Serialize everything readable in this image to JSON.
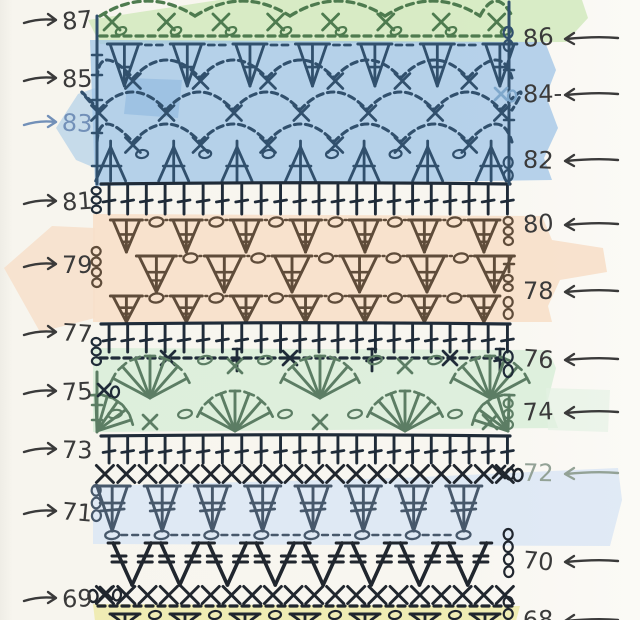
{
  "page": {
    "title": "Hand-drawn crochet stitch chart, rows 68-87, with highlighter color bands"
  },
  "inks": {
    "green": "#4e7b4f",
    "blueInk": "#31506d",
    "navy": "#1f2b38",
    "brown": "#5f4c3a",
    "slate": "#47586b",
    "black": "#20262e",
    "fan": "#5c7d64",
    "pencil": "#3a3a3a",
    "bluePencil": "#7290b8",
    "greenPencil": "#93a296",
    "lightBlue": "#7fa8cc"
  },
  "bands": [
    {
      "name": "band-green-top",
      "fill": "#cfe8ba",
      "opacity": 0.8,
      "points": "258,-6 580,-6 588,18 566,42 100,44 88,20"
    },
    {
      "name": "band-blue-upper",
      "fill": "#9fc4e7",
      "opacity": 0.75,
      "points": "90,40 545,42 556,70 546,96 558,128 544,158 552,180 95,186"
    },
    {
      "name": "band-blue-spike",
      "fill": "#9fc4e7",
      "opacity": 0.55,
      "points": "95,88 95,168 76,160 56,128 78,94"
    },
    {
      "name": "band-blue-patch",
      "fill": "#79abdb",
      "opacity": 0.38,
      "points": "128,78 182,80 178,118 124,114"
    },
    {
      "name": "band-orange-main",
      "fill": "#f7dfca",
      "opacity": 0.92,
      "points": "93,214 542,216 552,240 603,248 607,272 560,280 548,306 552,322 93,322"
    },
    {
      "name": "band-orange-left",
      "fill": "#f7dfca",
      "opacity": 0.85,
      "points": "95,228 95,318 40,332 4,268 52,226"
    },
    {
      "name": "band-green-mid",
      "fill": "#d9eeda",
      "opacity": 0.88,
      "points": "93,348 548,350 556,368 548,400 558,428 93,432"
    },
    {
      "name": "band-green-mid-right",
      "fill": "#e4f1e4",
      "opacity": 0.65,
      "points": "546,388 610,390 608,432 548,430"
    },
    {
      "name": "band-blue-lower",
      "fill": "#dbe6f4",
      "opacity": 0.85,
      "points": "93,486 400,478 618,468 622,500 610,546 93,544"
    },
    {
      "name": "band-yellow",
      "fill": "#eeebad",
      "opacity": 0.9,
      "points": "93,604 520,606 516,621 95,621"
    }
  ],
  "left_labels": [
    {
      "row": "87",
      "y": 20
    },
    {
      "row": "85",
      "y": 78
    },
    {
      "row": "83",
      "y": 122,
      "color": "#7290b8"
    },
    {
      "row": "81",
      "y": 201
    },
    {
      "row": "79",
      "y": 264
    },
    {
      "row": "77",
      "y": 332
    },
    {
      "row": "75",
      "y": 391
    },
    {
      "row": "73",
      "y": 449
    },
    {
      "row": "71",
      "y": 511
    },
    {
      "row": "69",
      "y": 598
    }
  ],
  "right_labels": [
    {
      "row": "86",
      "y": 38
    },
    {
      "row": "84-",
      "y": 94
    },
    {
      "row": "82",
      "y": 160
    },
    {
      "row": "80",
      "y": 224
    },
    {
      "row": "78",
      "y": 291
    },
    {
      "row": "76",
      "y": 359
    },
    {
      "row": "74",
      "y": 412
    },
    {
      "row": "72",
      "y": 473,
      "color": "#93a296"
    },
    {
      "row": "70",
      "y": 561
    },
    {
      "row": "68",
      "y": 620
    }
  ],
  "stitch_rows": [
    {
      "row": "88",
      "stitch": "chain-arc lace (partial, cut at top)",
      "type": "chain_arcs",
      "ink": "green",
      "y": 16,
      "amp": 15,
      "x0": 100,
      "x1": 512,
      "spacing": 95
    },
    {
      "row": "87",
      "stitch": "single crochet + chain loop",
      "type": "x_loop_row",
      "ink": "green",
      "y": 22,
      "x0": 112,
      "x1": 500,
      "spacing": 55
    },
    {
      "row": "87b",
      "stitch": "chain base",
      "type": "dash_line",
      "ink": "green",
      "y": 36,
      "x0": 100,
      "x1": 508
    },
    {
      "row": "86",
      "stitch": "3-dc cluster shells",
      "type": "v_cluster",
      "ink": "blueInk",
      "yT": 44,
      "yB": 86,
      "x0": 123,
      "spacing": 63,
      "count": 7,
      "w": 28
    },
    {
      "row": "85",
      "stitch": "chain-arc mesh with sc",
      "type": "mesh",
      "ink": "blueInk",
      "y": 78,
      "x0": 133,
      "spacing": 67,
      "count": 6,
      "amp": 18
    },
    {
      "row": "84",
      "stitch": "chain-arc mesh with sc",
      "type": "mesh",
      "ink": "blueInk",
      "y": 110,
      "x0": 99,
      "spacing": 67,
      "count": 7,
      "amp": 18
    },
    {
      "row": "83",
      "stitch": "chain-arc mesh with sc",
      "type": "mesh",
      "ink": "blueInk",
      "y": 142,
      "x0": 133,
      "spacing": 67,
      "count": 6,
      "amp": 18
    },
    {
      "row": "82",
      "stitch": "dc3tog decrease clusters",
      "type": "a_cluster",
      "ink": "blueInk",
      "yT": 147,
      "yB": 181,
      "x0": 112,
      "spacing": 63,
      "count": 7,
      "w": 30
    },
    {
      "row": "81",
      "stitch": "double crochet row",
      "type": "dc_row",
      "ink": "navy",
      "yT": 184,
      "yB": 214,
      "x0": 105,
      "x1": 508,
      "spacing": 19
    },
    {
      "row": "80",
      "stitch": "treble cluster shells + chains",
      "type": "v_cluster_oval",
      "ink": "brown",
      "yT": 220,
      "yB": 252,
      "x0": 125,
      "spacing": 60,
      "count": 7,
      "w": 26
    },
    {
      "row": "79",
      "stitch": "treble cluster shells + chains",
      "type": "v_cluster_oval",
      "ink": "brown",
      "yT": 256,
      "yB": 292,
      "x0": 155,
      "spacing": 68,
      "count": 6,
      "w": 34
    },
    {
      "row": "78",
      "stitch": "treble cluster shells + chains",
      "type": "v_cluster_oval",
      "ink": "brown",
      "yT": 296,
      "yB": 322,
      "x0": 125,
      "spacing": 60,
      "count": 7,
      "w": 26
    },
    {
      "row": "77",
      "stitch": "double crochet row",
      "type": "dc_row",
      "ink": "navy",
      "yT": 324,
      "yB": 352,
      "x0": 105,
      "x1": 508,
      "spacing": 19
    },
    {
      "row": "76",
      "stitch": "chain / sc / dc transition row",
      "type": "oval_x_row",
      "ink": "navy",
      "y": 358,
      "x0": 100,
      "x1": 506,
      "xs": [
        168,
        290,
        450
      ],
      "ts": [
        237,
        372,
        500
      ]
    },
    {
      "row": "75",
      "stitch": "fan shells",
      "type": "fan_row",
      "ink": "fan",
      "apexY": 398,
      "r": 42,
      "centers": [
        150,
        320,
        490
      ],
      "xs": [
        [
          235,
          366
        ],
        [
          405,
          366
        ]
      ],
      "ovals": [
        [
          205,
          360
        ],
        [
          265,
          360
        ],
        [
          375,
          360
        ],
        [
          435,
          360
        ]
      ]
    },
    {
      "row": "74",
      "stitch": "fan shells",
      "type": "fan_row",
      "ink": "fan",
      "apexY": 431,
      "r": 40,
      "centers": [
        235,
        405
      ],
      "halfLeft": 97,
      "halfRight": 508,
      "xs": [
        [
          150,
          422
        ],
        [
          320,
          422
        ],
        [
          490,
          422
        ]
      ],
      "ovals": [
        [
          115,
          414
        ],
        [
          185,
          414
        ],
        [
          285,
          414
        ],
        [
          355,
          414
        ],
        [
          455,
          414
        ]
      ]
    },
    {
      "row": "73",
      "stitch": "double crochet row",
      "type": "dc_row",
      "ink": "navy",
      "yT": 436,
      "yB": 463,
      "x0": 105,
      "x1": 508,
      "spacing": 19
    },
    {
      "row": "72",
      "stitch": "cross stitch row",
      "type": "x_row",
      "ink": "black",
      "y": 474,
      "x0": 105,
      "x1": 505,
      "spacing": 21,
      "endOval": true
    },
    {
      "row": "71",
      "stitch": "puff clusters with double bars",
      "type": "inv_cluster",
      "ink": "slate",
      "yT": 486,
      "yB": 531,
      "x0": 113,
      "spacing": 50,
      "count": 8,
      "w": 30
    },
    {
      "row": "70",
      "stitch": "V-stitches with double bars",
      "type": "big_v",
      "ink": "black",
      "yT": 543,
      "yB": 585,
      "x0": 132,
      "spacing": 48,
      "count": 8,
      "w": 38
    },
    {
      "row": "69",
      "stitch": "cross stitch row",
      "type": "x_row",
      "ink": "black",
      "y": 595,
      "x0": 105,
      "x1": 505,
      "spacing": 21,
      "startOval": true
    },
    {
      "row": "69b",
      "stitch": "chain base",
      "type": "dash_line",
      "ink": "black",
      "y": 606,
      "x0": 98,
      "x1": 512
    },
    {
      "row": "68",
      "stitch": "cluster shells (partial, cut at bottom)",
      "type": "partial_v",
      "ink": "black",
      "y": 611,
      "x0": 125,
      "spacing": 60,
      "count": 7
    }
  ],
  "edges": [
    {
      "type": "vline",
      "x": 97,
      "y0": 16,
      "y1": 184,
      "ink": "blueInk",
      "ticks": [
        55,
        75,
        100,
        133,
        166
      ]
    },
    {
      "type": "vline",
      "x": 509,
      "y0": 2,
      "y1": 184,
      "ink": "blueInk",
      "ticks": [
        70,
        120
      ]
    },
    {
      "type": "chain",
      "x": 97,
      "y0": 186,
      "y1": 214,
      "n": 3,
      "ink": "navy"
    },
    {
      "type": "chain",
      "x": 97,
      "y0": 246,
      "y1": 288,
      "n": 4,
      "ink": "brown"
    },
    {
      "type": "chain",
      "x": 97,
      "y0": 337,
      "y1": 366,
      "n": 3,
      "ink": "navy"
    },
    {
      "type": "vline",
      "x": 97,
      "y0": 372,
      "y1": 432,
      "ink": "fan",
      "ticks": [
        405,
        420
      ]
    },
    {
      "type": "chain",
      "x": 97,
      "y0": 484,
      "y1": 522,
      "n": 3,
      "ink": "slate"
    },
    {
      "type": "chain",
      "x": 509,
      "y0": 26,
      "y1": 52,
      "n": 2,
      "ink": "blueInk"
    },
    {
      "type": "xo",
      "x": 501,
      "y": 94,
      "ink": "lightBlue"
    },
    {
      "type": "chain",
      "x": 509,
      "y0": 156,
      "y1": 182,
      "n": 2,
      "ink": "blueInk"
    },
    {
      "type": "chain",
      "x": 509,
      "y0": 216,
      "y1": 246,
      "n": 3,
      "ink": "brown"
    },
    {
      "type": "tchain",
      "x": 509,
      "y0": 256,
      "y1": 292,
      "ink": "brown"
    },
    {
      "type": "chain",
      "x": 509,
      "y0": 296,
      "y1": 320,
      "n": 2,
      "ink": "brown"
    },
    {
      "type": "chain",
      "x": 509,
      "y0": 350,
      "y1": 378,
      "n": 2,
      "ink": "navy"
    },
    {
      "type": "chain",
      "x": 509,
      "y0": 398,
      "y1": 430,
      "n": 3,
      "ink": "fan"
    },
    {
      "type": "xo",
      "x": 499,
      "y": 472,
      "ink": "black"
    },
    {
      "type": "chain",
      "x": 509,
      "y0": 528,
      "y1": 578,
      "n": 4,
      "ink": "black"
    },
    {
      "type": "chain",
      "x": 509,
      "y0": 596,
      "y1": 620,
      "n": 2,
      "ink": "black"
    },
    {
      "type": "xo",
      "x": 104,
      "y": 390,
      "ink": "navy",
      "flip": true
    },
    {
      "type": "xo",
      "x": 106,
      "y": 593,
      "ink": "black",
      "flip": true
    }
  ]
}
